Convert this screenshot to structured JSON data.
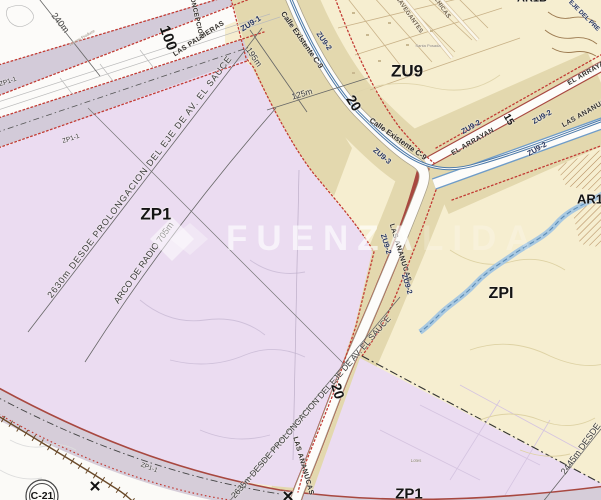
{
  "map": {
    "type": "zoning-plan",
    "watermark": {
      "text_strong": "FUENZA",
      "text_faint": "LIDA"
    },
    "colors": {
      "zone_zp1_lavender": "#ebdcf1",
      "zone_zu9_cream": "#f6eed0",
      "road_reserve_khaki": "#e3d8ae",
      "road_band_gray": "#d3cbd9",
      "boundary_dotted_red": "#c23b34",
      "road_edge_red": "#a84840",
      "road_existing_blue": "#4a78a8",
      "river_blue": "#a8c8e0"
    },
    "labels": {
      "t240": "240m",
      "t100": "100",
      "palmeras": "LAS PALMERAS",
      "concepcion": "CONCEPCION",
      "johnny": "Johnny Produce",
      "zu91": "ZU9-1",
      "calleC9a": "Calle Existente C-9",
      "zu92a": "ZU9-2",
      "t195": "195m",
      "t125": "125m",
      "zu9": "ZU9",
      "navegantes": "NAVEGANTES",
      "chicas": "CHICAS",
      "santa": "Santa Posada",
      "ar1b": "AR1B",
      "ejedelpre": "EJE DEL PRE",
      "arrayan1": "EL ARRAYAN",
      "arrayan2": "EL ARRAYAN",
      "zu92b": "ZU9-2",
      "zu92c": "ZU9-2",
      "zu92d": "ZU9-2",
      "ananucasE": "LAS ANANUCAS",
      "w15": "15",
      "calleC9b": "Calle Existente C-9",
      "zu93": "ZU9-3",
      "w20a": "20",
      "zu92e": "ZU9-2",
      "ananucasS1": "LAS ANANUCAS",
      "zu92f": "ZU9-2",
      "ar1": "AR1",
      "zpi": "ZPI",
      "zp1": "ZP1",
      "d2630": "2630m DESDE PROLONGACION DEL EJE DE AV. EL SAUCE",
      "arco": "ARCO DE RADIO 705m",
      "d2635": "2635m DESDE PROLONGACION DEL EJE DE AV. EL SAUCE",
      "d2445": "2445m DESDE",
      "zp1b": "ZP1",
      "zp11a": "ZP1-1",
      "zp11b": "ZP1-1",
      "zp11c": "ZP1-1",
      "c21": "C-21",
      "xa": "✕",
      "xb": "✕",
      "lotes": "Lotes",
      "w20b": "20",
      "ananucasS2": "LAS ANANUCAS"
    }
  }
}
